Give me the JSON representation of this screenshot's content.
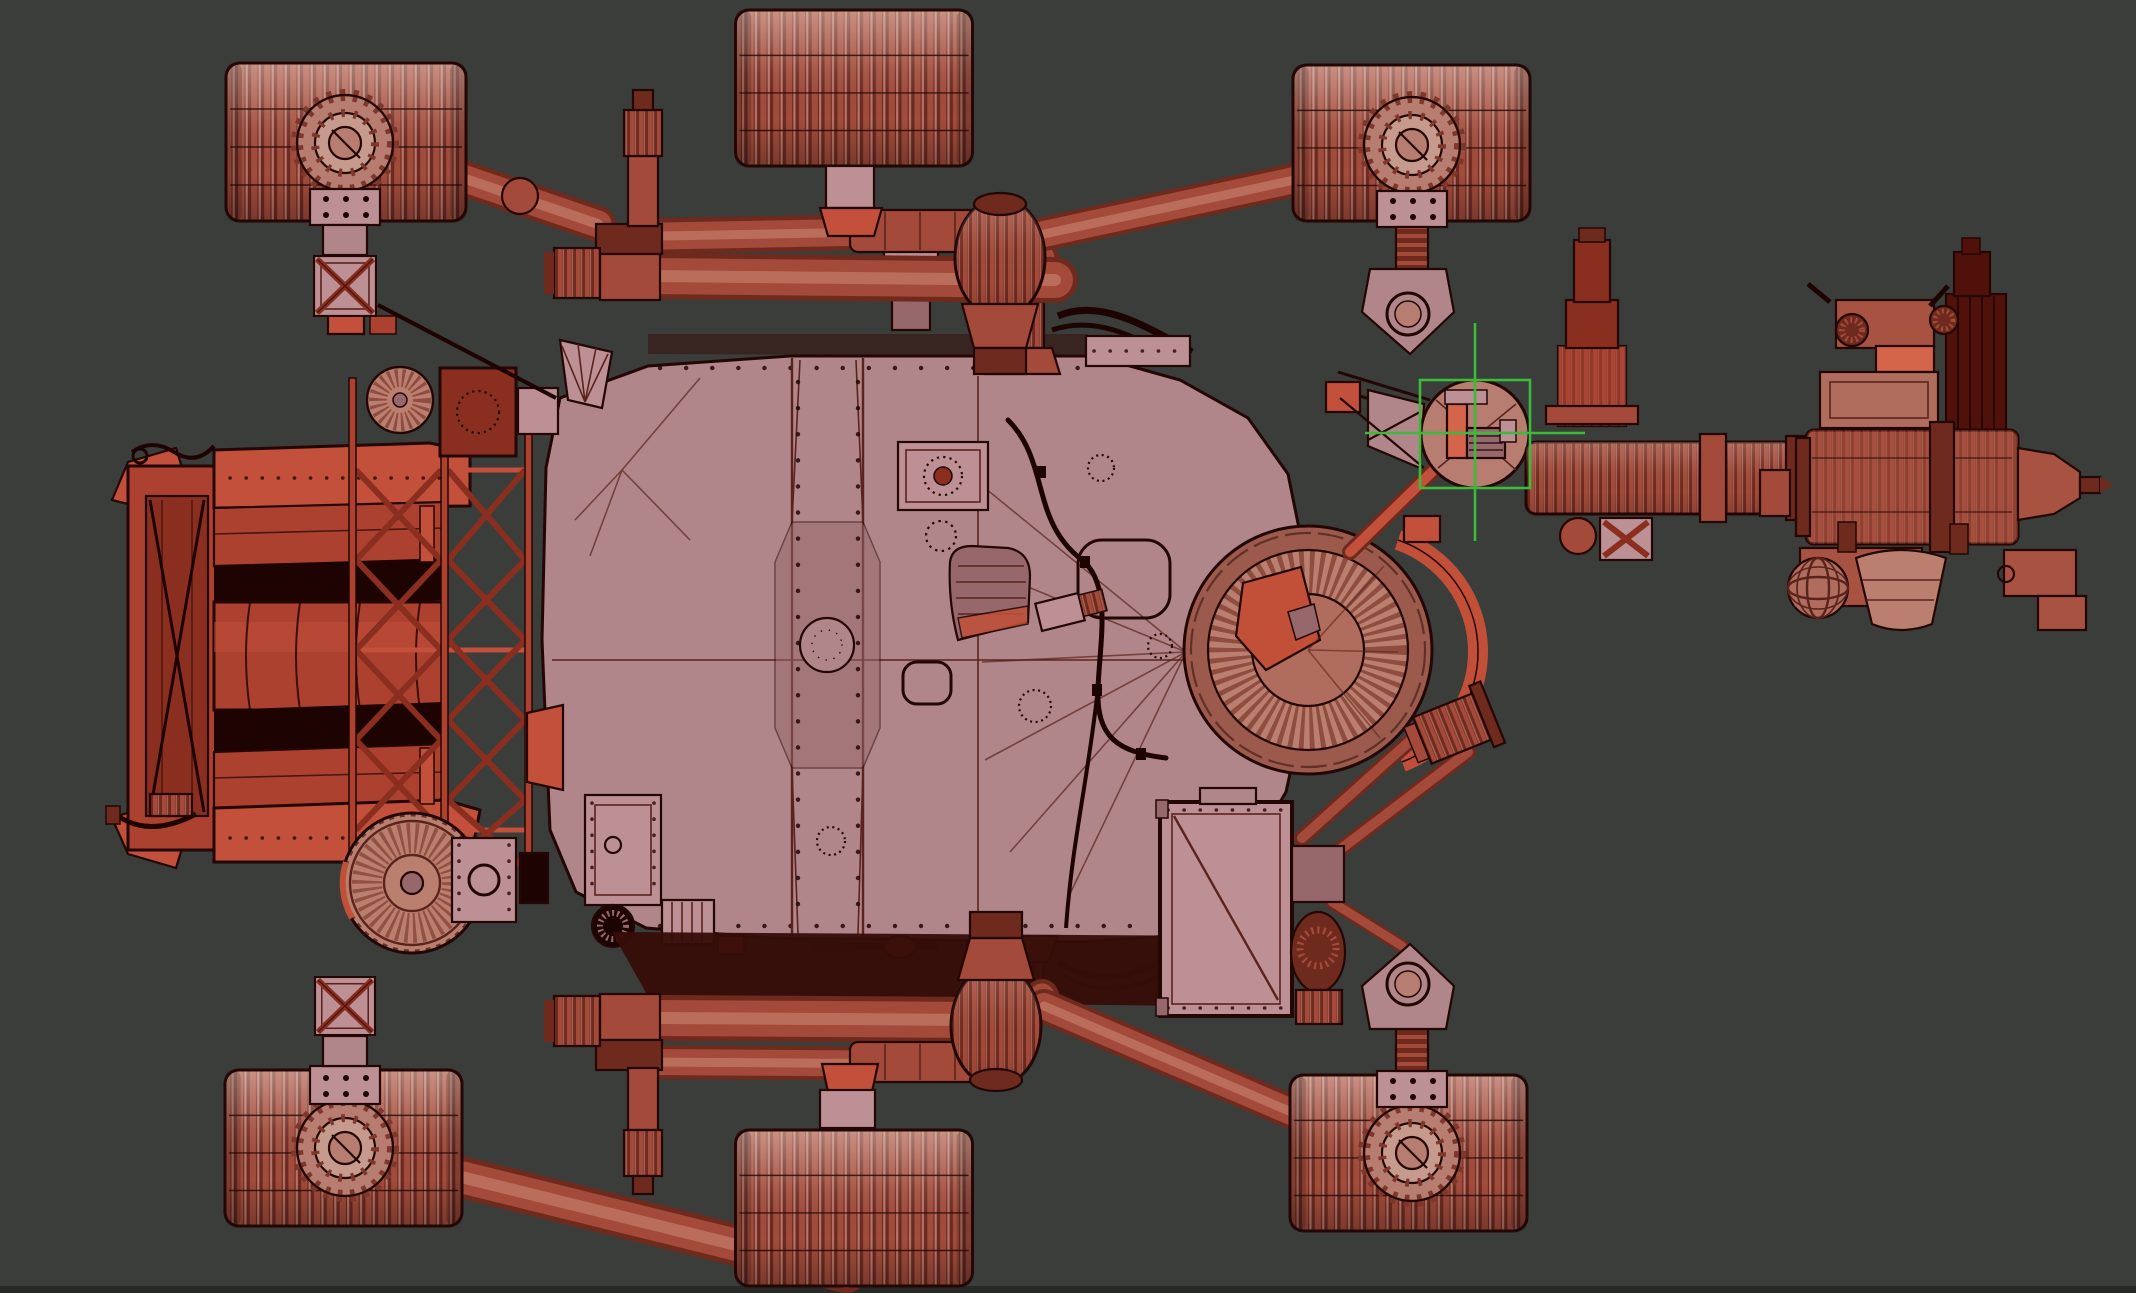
{
  "scene": {
    "type": "3d-viewport",
    "description": "Wireframe-over-shaded model of a six-wheeled Mars rover seen from directly above in a dark 3D viewport",
    "view": "top-orthographic",
    "model": "mars-rover",
    "text_visible": "none"
  },
  "components": [
    {
      "name": "wheel-top-rear"
    },
    {
      "name": "wheel-top-middle"
    },
    {
      "name": "wheel-top-front"
    },
    {
      "name": "wheel-bottom-rear"
    },
    {
      "name": "wheel-bottom-middle"
    },
    {
      "name": "wheel-bottom-front"
    },
    {
      "name": "rocker-bogie-suspension-top"
    },
    {
      "name": "rocker-bogie-suspension-bottom"
    },
    {
      "name": "chassis-deck"
    },
    {
      "name": "rtg-power-block"
    },
    {
      "name": "rtg-truss"
    },
    {
      "name": "instrument-dish"
    },
    {
      "name": "robotic-arm-shoulder"
    },
    {
      "name": "robotic-arm-forearm"
    },
    {
      "name": "arm-turret"
    },
    {
      "name": "cooling-fan-top"
    },
    {
      "name": "cooling-fan-bottom"
    },
    {
      "name": "belly-panel"
    },
    {
      "name": "side-access-panel"
    },
    {
      "name": "tracking-marker"
    }
  ],
  "marker": {
    "shape": "crosshair-with-square",
    "color": "#3cba3c"
  },
  "colors": {
    "bg": "#3a3d3a",
    "edgeStrip": "#272927",
    "outline": "#230704",
    "seam": "#5a241d",
    "deck": "#b1868a",
    "deckShade": "#96686c",
    "panel": "#bc9094",
    "belly": "#360d08",
    "wheelDark": "#6b2a20",
    "wheelMid": "#a24c3c",
    "wheelLight": "#c98475",
    "hubFace": "#b67d70",
    "hubFace2": "#c79a8e",
    "hubRing": "#7e382b",
    "tube": "#a34a3a",
    "tubeDark": "#6f2a1e",
    "tubeHi": "#cf8b78",
    "red": "#ad4130",
    "redBeam": "#c2503a",
    "redDark": "#8a2f20",
    "nearBlack": "#1d0402",
    "dishRim": "#9c5a4c",
    "dishFin": "#bb7f70",
    "dishMid": "#8f4d3f",
    "dishInner": "#b06c5d",
    "dishRed": "#c24f38",
    "turBody": "#a85342",
    "turDark": "#4f110a",
    "turOrange": "#d4644a",
    "green": "#3cba3c"
  }
}
